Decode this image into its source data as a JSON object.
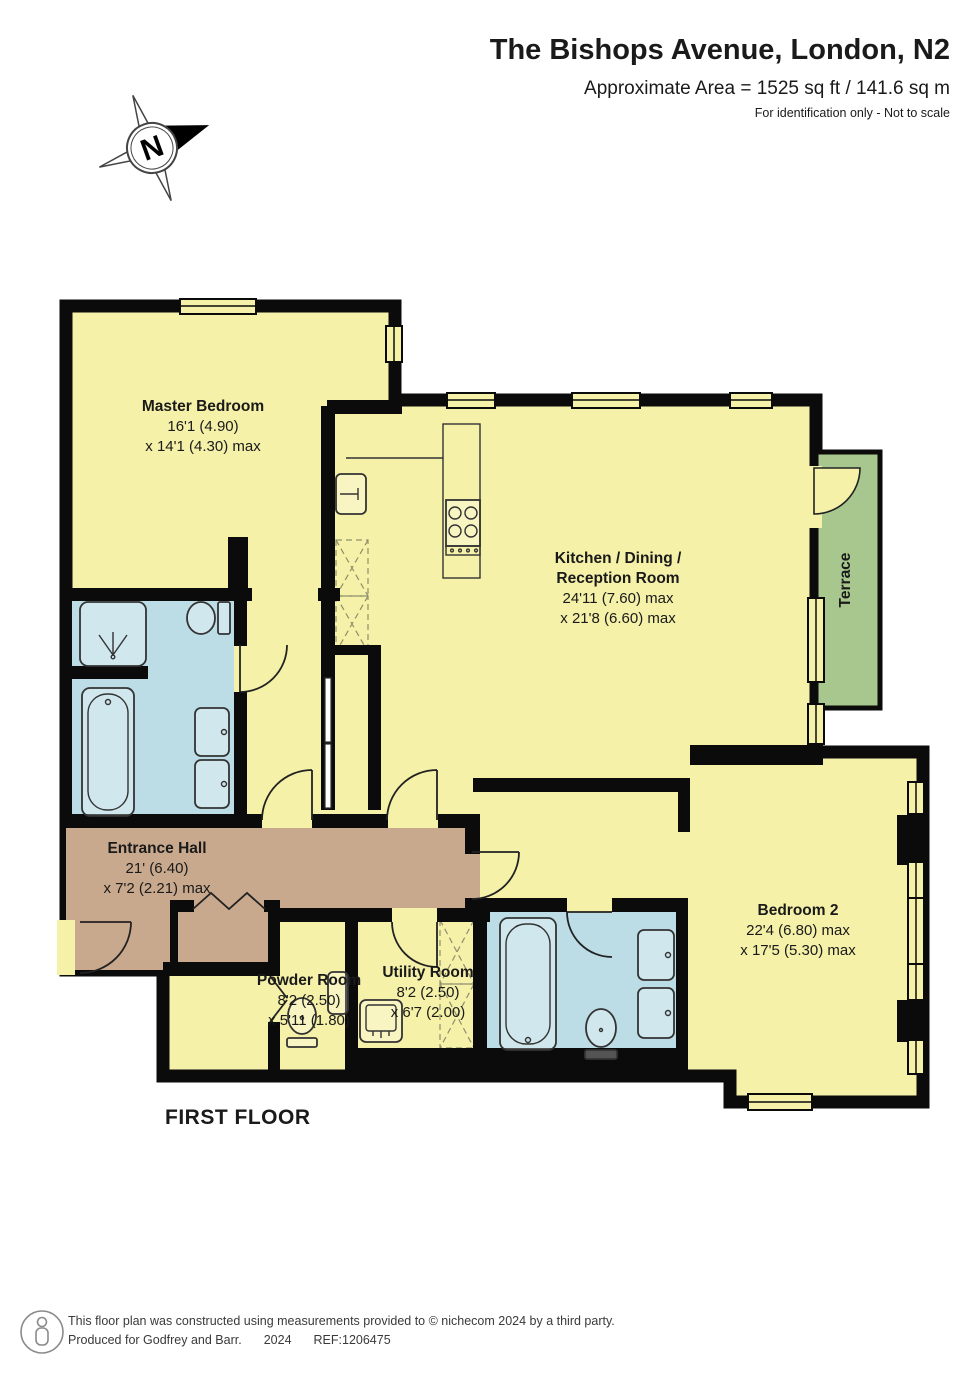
{
  "header": {
    "title": "The Bishops Avenue, London, N2",
    "area_line": "Approximate Area = 1525 sq ft / 141.6 sq m",
    "note": "For identification only - Not to scale"
  },
  "compass": {
    "letter": "N"
  },
  "floor_label": "FIRST FLOOR",
  "rooms": [
    {
      "id": "master-bedroom",
      "name": "Master Bedroom",
      "dim1": "16'1 (4.90)",
      "dim2": "x 14'1 (4.30) max"
    },
    {
      "id": "kitchen-dining-reception",
      "name": "Kitchen / Dining /",
      "name2": "Reception Room",
      "dim1": "24'11 (7.60) max",
      "dim2": "x 21'8 (6.60) max"
    },
    {
      "id": "terrace",
      "name": "Terrace"
    },
    {
      "id": "entrance-hall",
      "name": "Entrance Hall",
      "dim1": "21' (6.40)",
      "dim2": "x 7'2 (2.21) max"
    },
    {
      "id": "powder-room",
      "name": "Powder Room",
      "dim1": "8'2 (2.50)",
      "dim2": "x 5'11 (1.80)"
    },
    {
      "id": "utility-room",
      "name": "Utility Room",
      "dim1": "8'2 (2.50)",
      "dim2": "x 6'7 (2.00)"
    },
    {
      "id": "bedroom-2",
      "name": "Bedroom 2",
      "dim1": "22'4 (6.80) max",
      "dim2": "x 17'5 (5.30) max"
    }
  ],
  "footer": {
    "line1": "This floor plan was constructed using measurements provided to © nichecom 2024 by a third party.",
    "produced": "Produced for Godfrey and Barr.",
    "year": "2024",
    "ref": "REF:1206475"
  },
  "colors": {
    "room_fill": "#F5F1A8",
    "hall_fill": "#C8A98D",
    "bath_fill": "#BCDDE5",
    "terrace_fill": "#A7C78E",
    "wall": "#0B0B0B"
  }
}
